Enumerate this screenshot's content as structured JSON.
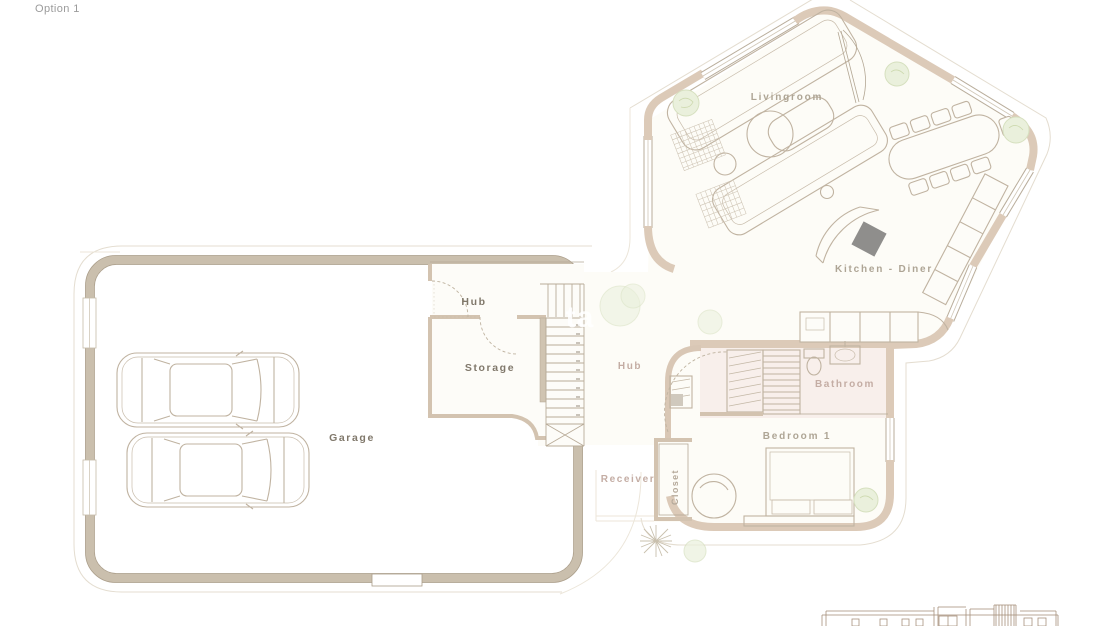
{
  "page": {
    "title": "Option 1",
    "type_note": "architectural ground-floor plan, option 1",
    "background": "#ffffff"
  },
  "watermark": {
    "visible_text": "ta"
  },
  "plan": {
    "rooms": [
      {
        "id": "livingroom",
        "label": "Livingroom"
      },
      {
        "id": "kitchen-diner",
        "label": "Kitchen - Diner"
      },
      {
        "id": "hub-upper",
        "label": "Hub"
      },
      {
        "id": "storage",
        "label": "Storage"
      },
      {
        "id": "garage",
        "label": "Garage"
      },
      {
        "id": "hub-entry",
        "label": "Hub"
      },
      {
        "id": "bathroom",
        "label": "Bathroom"
      },
      {
        "id": "bedroom-1",
        "label": "Bedroom 1"
      },
      {
        "id": "receiver",
        "label": "Receiver"
      },
      {
        "id": "closet",
        "label": "Closet"
      }
    ],
    "features": {
      "cars_in_garage": 2,
      "stair_treads": 13,
      "dining_chairs": 9,
      "sofas": 2,
      "bed_count": 1,
      "plants": 6,
      "palm_tree": 1,
      "shower": 1,
      "toilet": 1,
      "sink": 1,
      "cooktop_dark_square": 1
    },
    "colors": {
      "garage_floor": "#f9f1e4",
      "house_floor": "#fdfcf7",
      "bathroom_floor": "#f8efeb",
      "garage_wall": "#cabfad",
      "house_wall": "#dccab8",
      "furniture_line": "#c0b3a1",
      "plant_green": "#eaf0dc",
      "cooktop_gray": "#8f8e8c",
      "label_dark": "#80786b",
      "label_muted": "#aea595",
      "label_pink": "#c4ada4"
    },
    "inset_elevation": "small front-elevation drawing, bottom right, cut off at page edge"
  }
}
